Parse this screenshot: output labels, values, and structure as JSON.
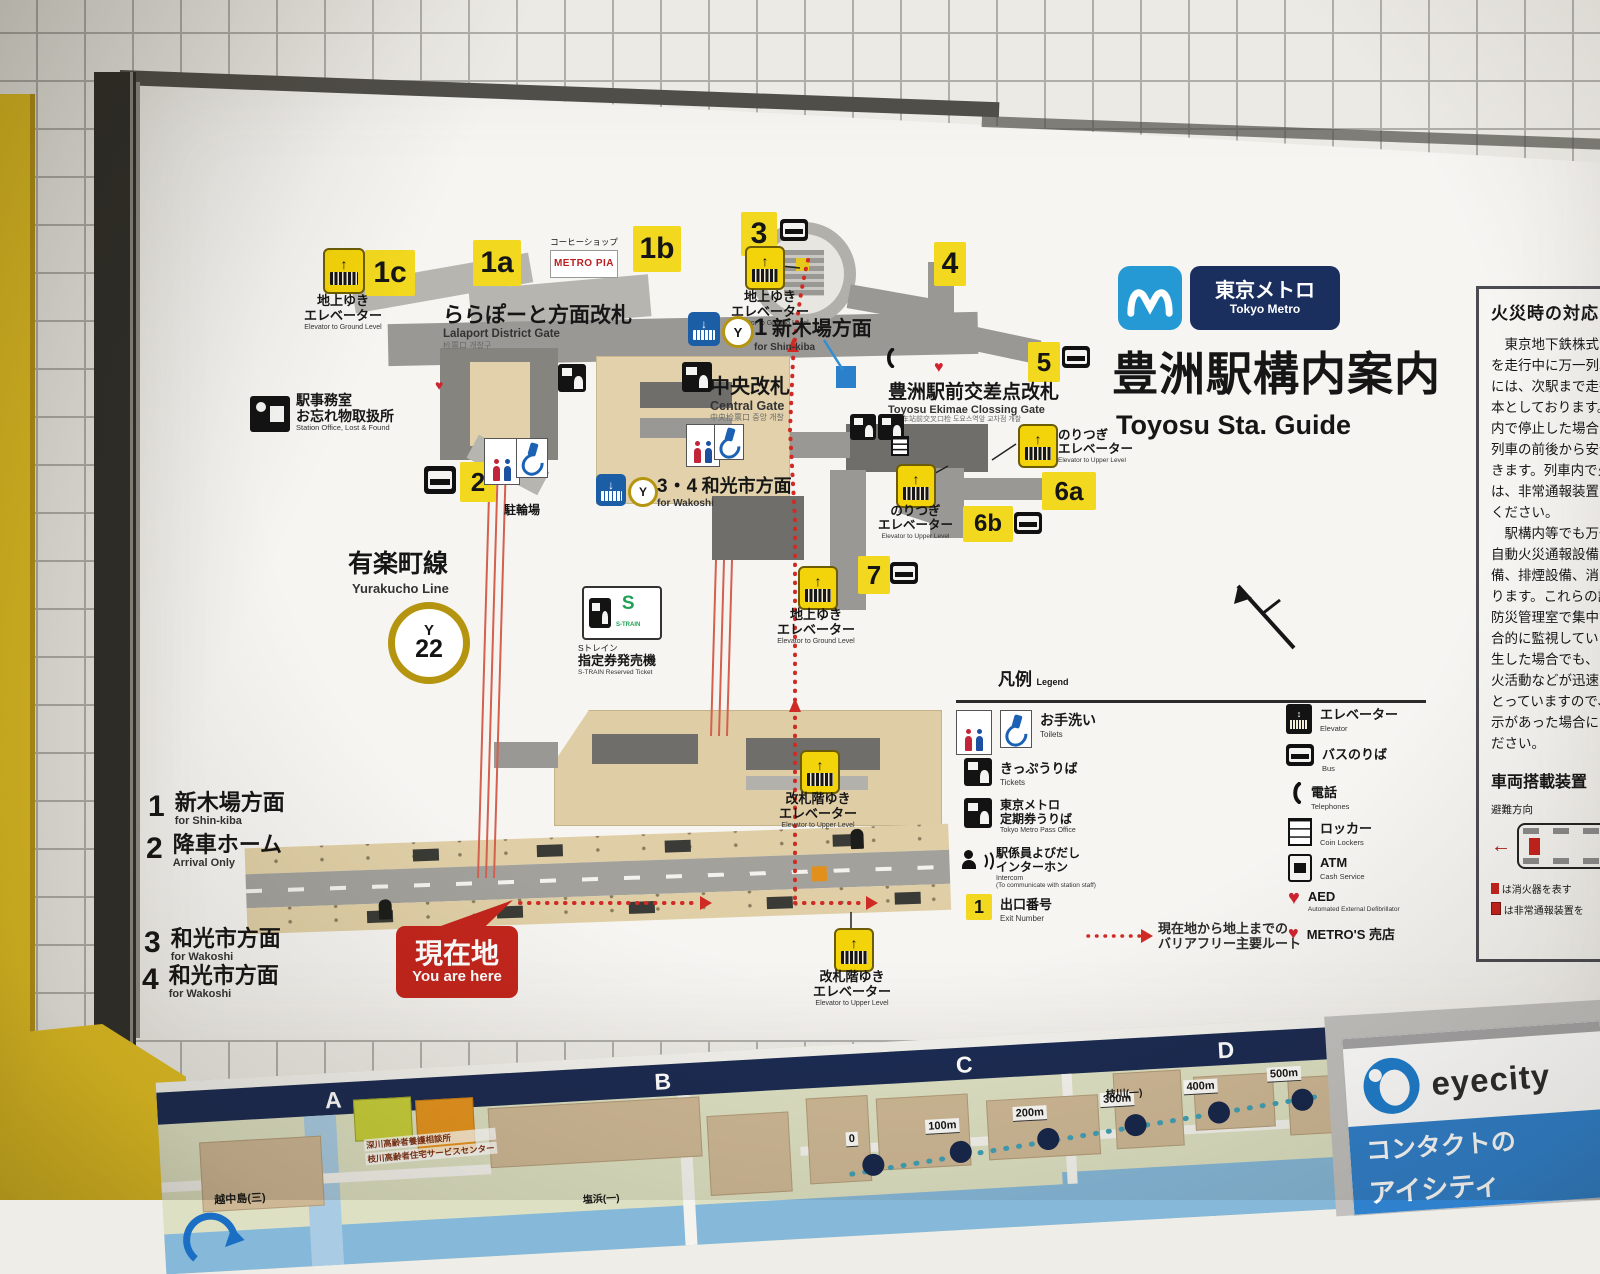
{
  "header": {
    "metro_jp": "東京メトロ",
    "metro_en": "Tokyo Metro",
    "title_jp": "豊洲駅構内案内",
    "title_en": "Toyosu Sta. Guide"
  },
  "line_info": {
    "line_jp": "有楽町線",
    "line_en": "Yurakucho Line",
    "code_letter": "Y",
    "code_number": "22"
  },
  "exit_badges": {
    "b1a": "1a",
    "b1b": "1b",
    "b1c": "1c",
    "b2": "2",
    "b3": "3",
    "b4": "4",
    "b5": "5",
    "b6a": "6a",
    "b6b": "6b",
    "b7": "7"
  },
  "labels": {
    "elevator_to_ground": {
      "jp": "地上ゆき\nエレベーター",
      "en": "Elevator to Ground Level"
    },
    "elevator_transfer": {
      "jp": "のりつぎ\nエレベーター",
      "en": "Elevator to Upper Level"
    },
    "elevator_to_gate": {
      "jp": "改札階ゆき\nエレベーター",
      "en": "Elevator to Upper Level"
    },
    "coffee_shop": {
      "label": "コーヒーショップ",
      "brand": "METRO PIA"
    },
    "bicycle": "駐輪場",
    "station_office": {
      "jp1": "駅事務室",
      "jp2": "お忘れ物取扱所",
      "en": "Station Office, Lost & Found"
    },
    "direction_shinkiba": {
      "num": "1",
      "jp": "新木場方面",
      "en": "for Shin-kiba"
    },
    "direction_wakoshi": {
      "num": "3・4",
      "jp": "和光市方面",
      "en": "for Wakoshi"
    },
    "strain": {
      "s": "S",
      "logo": "S-TRAIN",
      "jp1": "Sトレイン",
      "jp2": "指定券発売機",
      "en": "S-TRAIN Reserved Ticket"
    },
    "you_are_here": {
      "jp": "現在地",
      "en": "You are here"
    },
    "route_note": {
      "l1": "現在地から地上までの",
      "l2": "バリアフリー主要ルート"
    }
  },
  "gates": {
    "lalaport": {
      "jp": "ららぽーと方面改札",
      "en": "Lalaport District Gate",
      "sub": "检票口 개찰구"
    },
    "central": {
      "jp": "中央改札",
      "en": "Central Gate",
      "sub": "中央检票口 중앙 개찰"
    },
    "ekimae": {
      "jp": "豊洲駅前交差点改札",
      "en": "Toyosu Ekimae Clossing Gate",
      "sub": "丰洲车站前交叉口检 도요스역앞 교차점 개찰"
    }
  },
  "platforms": [
    {
      "num": "1",
      "jp": "新木場方面",
      "en": "for Shin-kiba"
    },
    {
      "num": "2",
      "jp": "降車ホーム",
      "en": "Arrival Only"
    },
    {
      "num": "3",
      "jp": "和光市方面",
      "en": "for Wakoshi"
    },
    {
      "num": "4",
      "jp": "和光市方面",
      "en": "for Wakoshi"
    }
  ],
  "legend": {
    "title_jp": "凡例",
    "title_en": "Legend",
    "left": [
      {
        "jp": "お手洗い",
        "en": "Toilets"
      },
      {
        "jp": "きっぷうりば",
        "en": "Tickets"
      },
      {
        "jp": "東京メトロ\n定期券うりば",
        "en": "Tokyo Metro Pass Office"
      },
      {
        "jp": "駅係員よびだし\nインターホン",
        "en": "Intercom",
        "en2": "(To communicate with station staff)"
      },
      {
        "jp": "出口番号",
        "en": "Exit Number",
        "badge": "1"
      }
    ],
    "right": [
      {
        "jp": "エレベーター",
        "en": "Elevator"
      },
      {
        "jp": "バスのりば",
        "en": "Bus"
      },
      {
        "jp": "電話",
        "en": "Telephones"
      },
      {
        "jp": "ロッカー",
        "en": "Coin Lockers"
      },
      {
        "jp": "ATM",
        "en": "Cash Service"
      },
      {
        "jp": "AED",
        "en": "Automated External Defibrillator"
      },
      {
        "jp": "METRO'S 売店",
        "en": ""
      }
    ]
  },
  "fire_panel": {
    "title": "火災時の対応",
    "body": [
      "　東京地下鉄株式会",
      "を走行中に万一列車",
      "には、次駅まで走行",
      "本としております。",
      "内で停止した場合は",
      "列車の前後から安全",
      "きます。列車内で火",
      "は、非常通報装置に",
      "ください。",
      "　駅構内等でも万一",
      "自動火災通報設備を",
      "備、排煙設備、消火",
      "ります。これらの設",
      "防災管理室で集中管",
      "合的に監視していま",
      "生した場合でも、お",
      "火活動などが迅速・",
      "とっていますので、",
      "示があった場合には",
      "ださい。"
    ],
    "equip_title": "車両搭載装置",
    "evac": "避難方向",
    "note1": "は消火器を表す",
    "note2": "は非常通報装置を"
  },
  "area_map": {
    "sections": [
      "A",
      "B",
      "C",
      "D"
    ],
    "distances": [
      "0",
      "100m",
      "200m",
      "300m",
      "400m",
      "500m"
    ],
    "places": {
      "etchujima": "越中島(三)",
      "shiohama": "塩浜(一)",
      "edagawa": "枝川(一)",
      "service1": "深川高齢者養護相談所",
      "service2": "枝川高齢者住宅サービスセンター"
    }
  },
  "ad": {
    "brand": "eyecity",
    "line1": "コンタクトの",
    "line2": "アイシティ"
  }
}
